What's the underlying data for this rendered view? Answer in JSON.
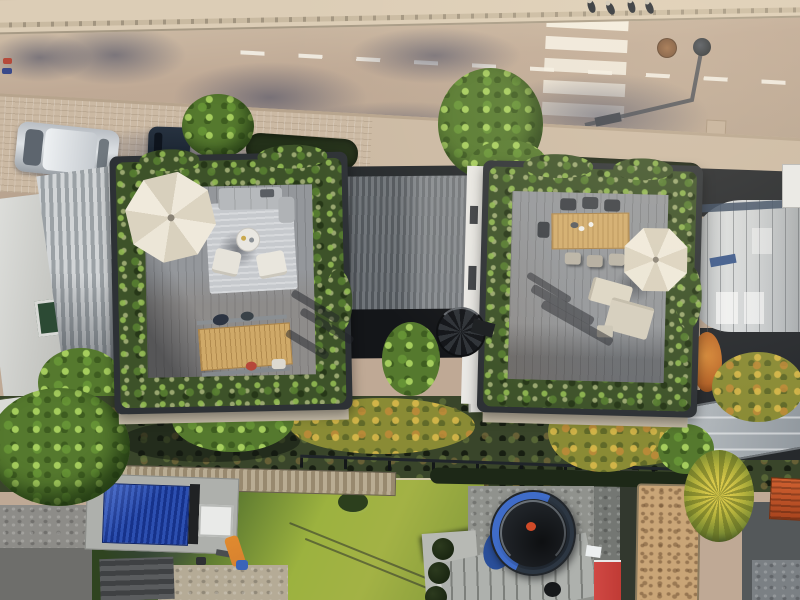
{
  "image_kind": "aerial drone photograph, top-down view of two modern rooftop terraces with planted borders, a street above and back gardens below",
  "colors": {
    "road": "#bfa995",
    "sidewalk-top": "#dccdb6",
    "sidewalk-mid": "#cbb9a3",
    "charcoal": "#2d3135",
    "deck": "#94979b",
    "rug": "#c6c9cd",
    "umbrella": "#eae3d3",
    "wood": "#cfa968",
    "lawn-lit": "#a3b245",
    "lawn-shade": "#2f4420",
    "shed-blue": "#2c4fb0",
    "tramp-rim": "#3f6cc9",
    "sand": "#c9a577",
    "cabinet-red": "#c03b35",
    "slide-orange": "#d8822f",
    "ribbed-light": "#d2d5d7",
    "curved-roof": "#cfd2d4",
    "facade-white": "#e9e8e4",
    "parapet": "#c9bfab"
  },
  "objects": {
    "street": {
      "label": "sunlit street with tree shadows and dashed centre line"
    },
    "crosswalk": {
      "label": "zebra crosswalk, 5 white stripes"
    },
    "street_lamp": {
      "label": "street lamp seen from above with long shadow"
    },
    "manhole": {
      "label": "round manhole cover"
    },
    "pedestrians": {
      "label": "pedestrians on upper sidewalk"
    },
    "silver_car": {
      "label": "silver car parked along the curb"
    },
    "dark_car": {
      "label": "dark car parked under street tree"
    },
    "street_trees": {
      "label": "green street trees"
    },
    "left_neighbor_roofs": {
      "label": "white roof and corrugated roof of neighbouring house"
    },
    "left_terrace": {
      "label": "left rooftop terrace: parasol, grey lounge rug set, timber dining table, planted edge"
    },
    "connector_roof": {
      "label": "grey standing-seam roof between the two houses with spiral staircase"
    },
    "right_terrace": {
      "label": "right rooftop terrace: timber dining table, parasol, beige lounge set, planted edge"
    },
    "curved_roof": {
      "label": "neighbouring barrel-vaulted metal roof"
    },
    "embankment": {
      "label": "planted embankment strip behind the houses"
    },
    "boardwalk": {
      "label": "slatted garden path"
    },
    "fence": {
      "label": "dark garden fence line"
    },
    "lawn": {
      "label": "back garden lawn, half in shadow"
    },
    "shed": {
      "label": "garden shed with blue panelled roof and white rooflight"
    },
    "slide": {
      "label": "children's slide"
    },
    "trampoline": {
      "label": "trampoline with blue rim"
    },
    "sand_patch": {
      "label": "bare sandy planting bed"
    },
    "red_cabinet": {
      "label": "red garden cabinet"
    },
    "glass_canopy": {
      "label": "glass canopy over lower terrace"
    },
    "orange_structure": {
      "label": "orange slatted structure"
    },
    "drying_rack": {
      "label": "rotary clothes dryer"
    }
  }
}
